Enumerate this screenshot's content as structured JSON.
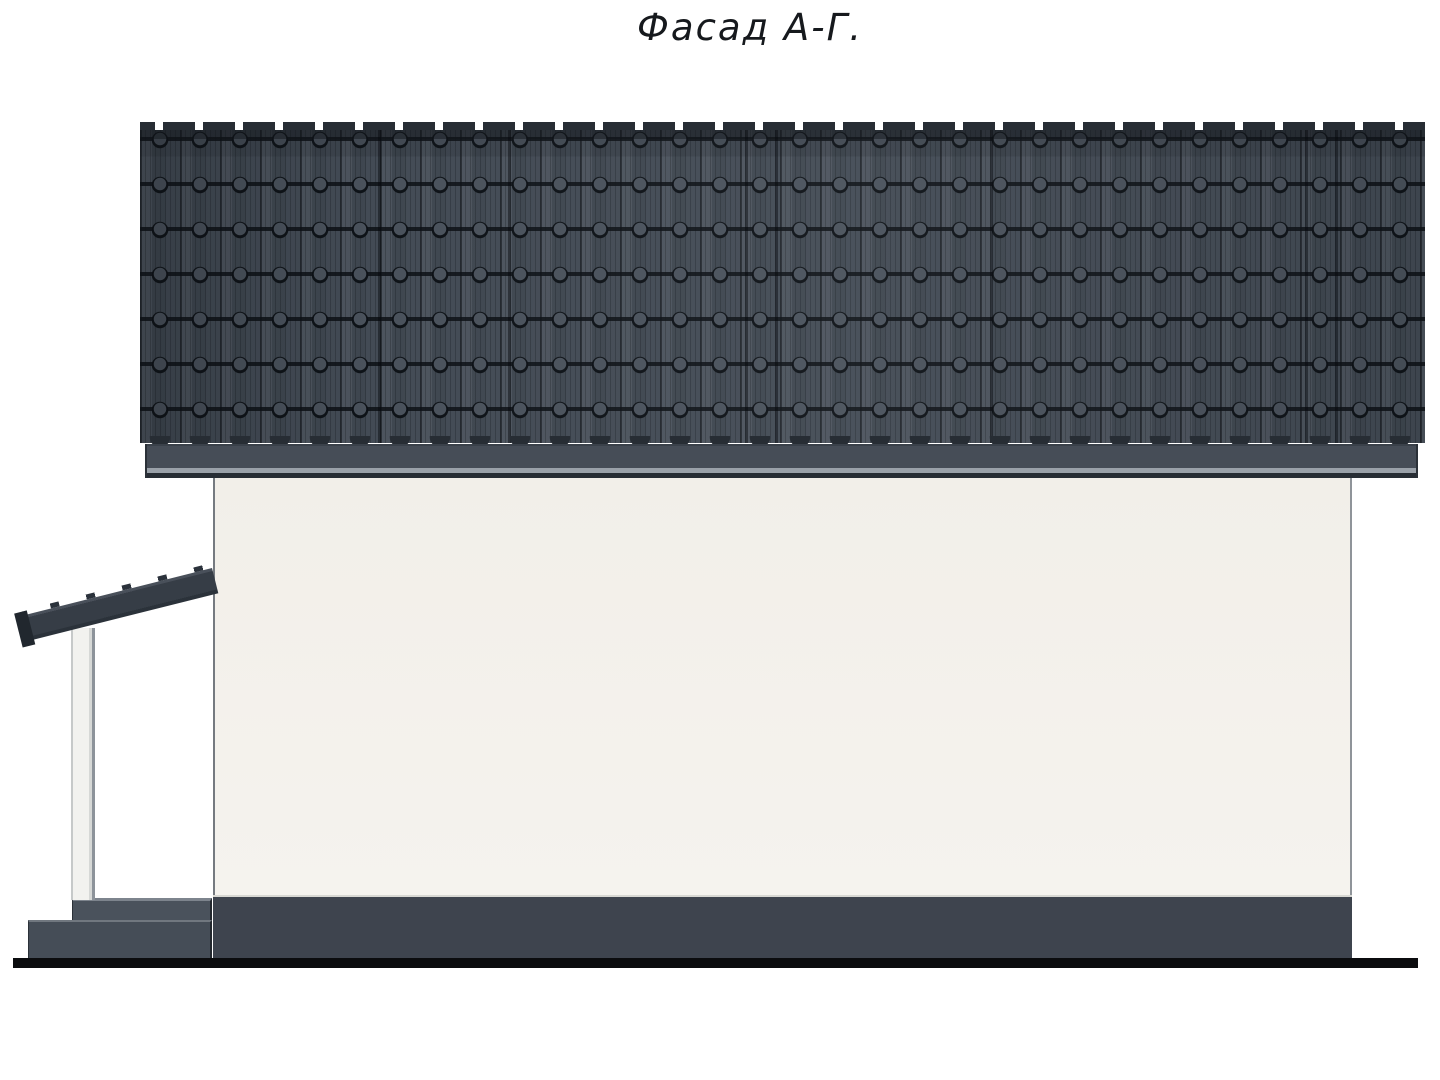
{
  "title": "Фасад А-Г.",
  "colors": {
    "title_color": "#16191d",
    "roof_tile_base": "#434b55",
    "roof_tile_cap": "#4a525c",
    "roof_edge_dark": "#272d34",
    "fascia_body": "#464d57",
    "fascia_light_edge": "#9aa1a9",
    "wall_fill": "#f2efe9",
    "wall_edge": "#757a80",
    "plinth_main": "#3e444e",
    "plinth_porch": "#4a525c",
    "plinth_top_light": "#d8d8d3",
    "beam_dark": "#363d46",
    "post_fill": "#f2f2ef",
    "ground_black": "#0b0c0e"
  },
  "roof_seam_positions_px": [
    378,
    508,
    745,
    775,
    990,
    1305,
    1335
  ]
}
